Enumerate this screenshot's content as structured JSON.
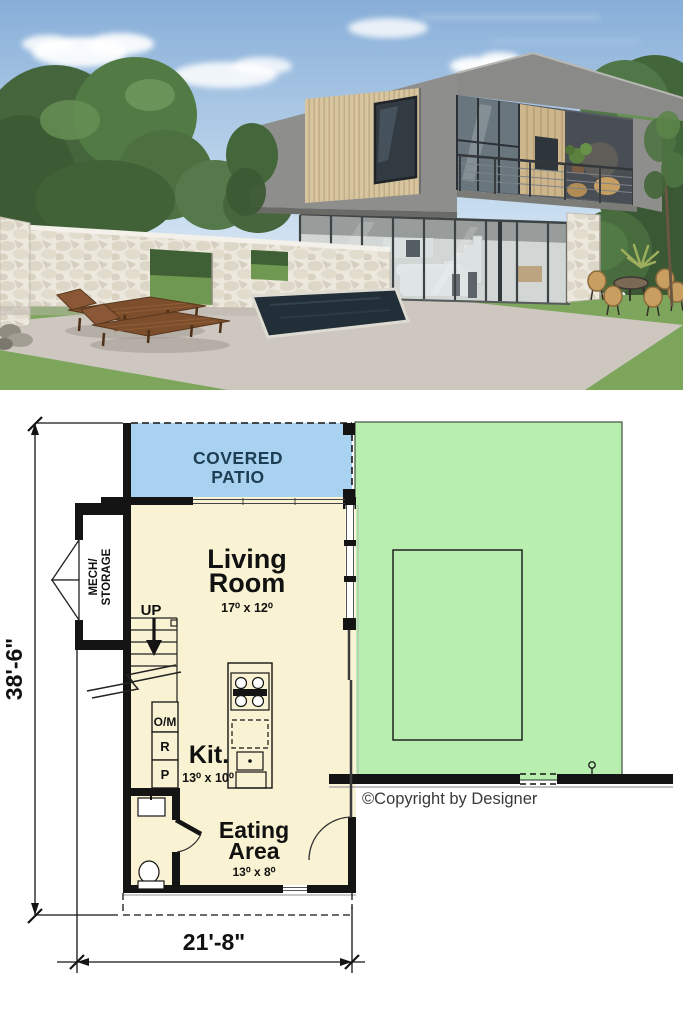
{
  "render": {
    "description": "3D exterior render of a modern two-story flat-roof house with wood cladding, balcony, glass lower level, stone privacy wall, pool and lounge chairs",
    "colors": {
      "sky_top": "#87aed8",
      "sky_bottom": "#e9f1f8",
      "concrete": "#8e8e8c",
      "wood_cladding": "#d7c5a0",
      "stone_wall": "#ece8dd",
      "patio_ground": "#cdc7c0",
      "grass": "#7da65c",
      "pool_water": "#222e38"
    }
  },
  "floor_plan": {
    "labels": {
      "covered_patio_line1": "COVERED",
      "covered_patio_line2": "PATIO",
      "living_room_line1": "Living",
      "living_room_line2": "Room",
      "living_room_dims": "17⁰ x 12⁰",
      "kitchen_name": "Kit.",
      "kitchen_dims": "13⁰ x 10⁰",
      "eating_area_line1": "Eating",
      "eating_area_line2": "Area",
      "eating_area_dims": "13⁰ x 8⁰",
      "mech_storage_line1": "MECH/",
      "mech_storage_line2": "STORAGE",
      "stairs_label": "UP",
      "appliance_oven_microwave": "O/M",
      "appliance_refrigerator": "R",
      "appliance_pantry": "P"
    },
    "dimensions": {
      "overall_depth": "38'-6\"",
      "overall_width": "21'-8\""
    },
    "copyright": "©Copyright by Designer",
    "colors": {
      "patio_fill": "#a9d2f1",
      "patio_text": "#1d3e53",
      "floor_fill": "#faf3d3",
      "lawn_fill": "#b9efae",
      "wall": "#141414",
      "copyright_text": "#3a3a3a"
    }
  }
}
